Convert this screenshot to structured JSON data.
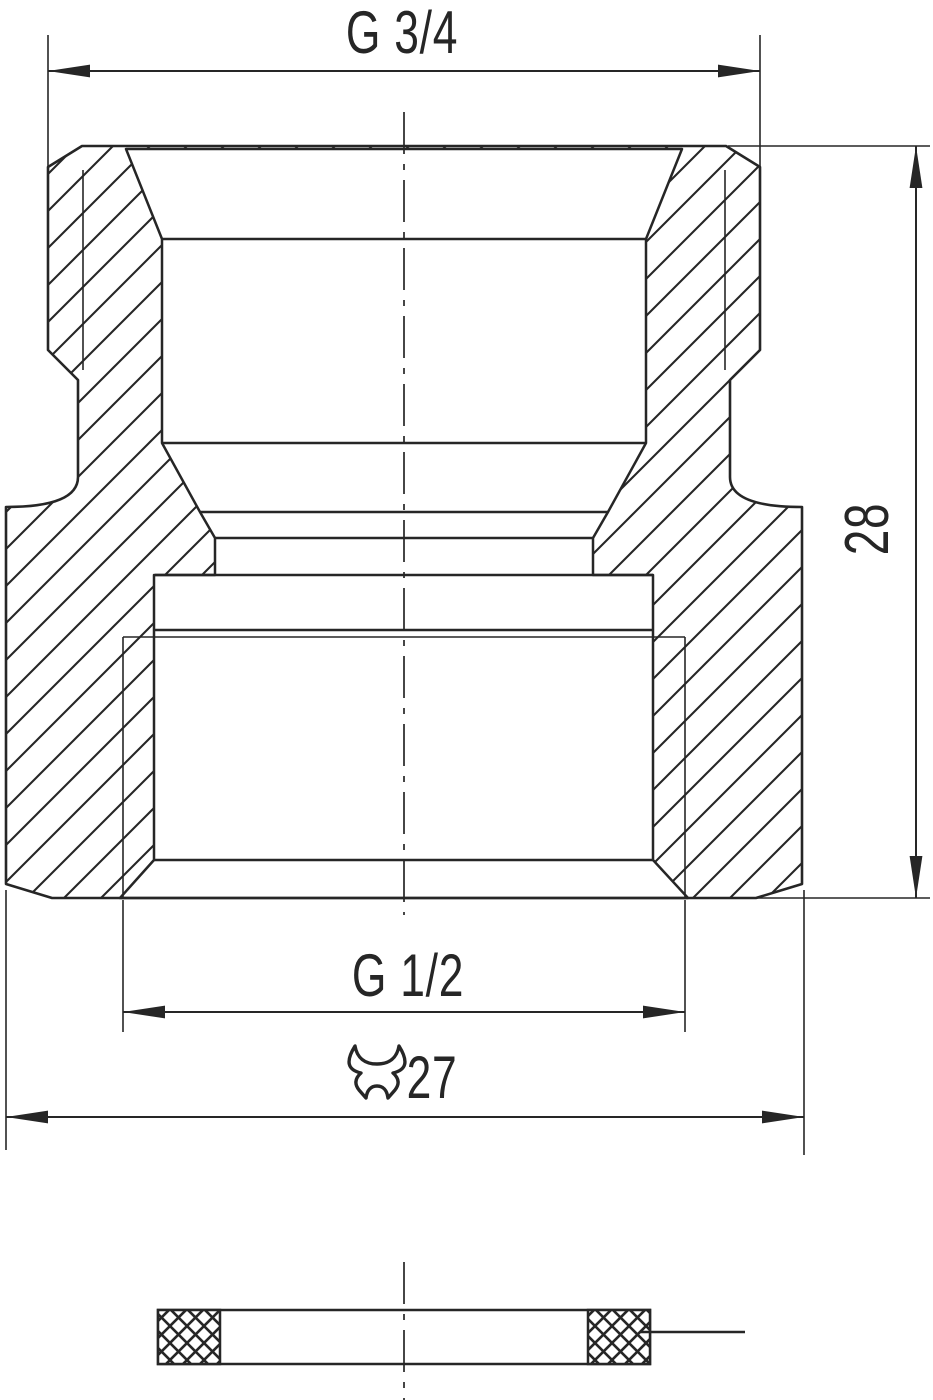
{
  "drawing": {
    "type": "technical-section-drawing",
    "background_color": "#ffffff",
    "line_color": "#262626",
    "views": {
      "main_view": "threaded reducing fitting, full section with hatching",
      "detail_view": "flat sealing washer, section with cross-hatch"
    },
    "dimensions": {
      "top_thread_label": "G 3/4",
      "overall_height_label": "28",
      "bottom_thread_label": "G 1/2",
      "wrench_size_label": "27",
      "wrench_icon": "wrench-icon"
    }
  }
}
